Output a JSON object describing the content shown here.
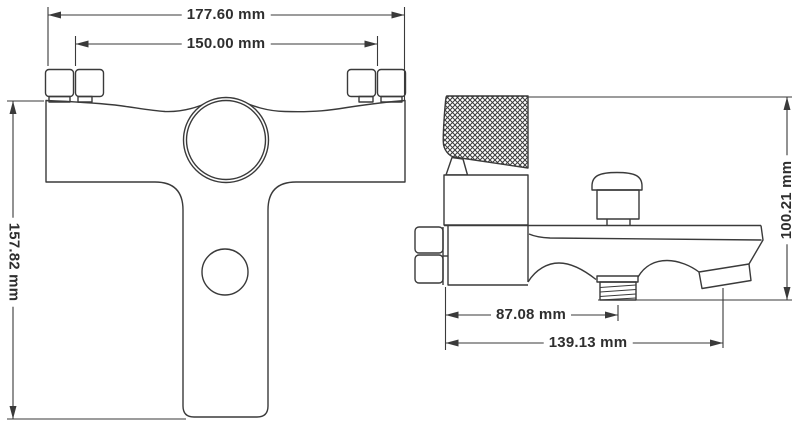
{
  "drawing": {
    "front_view": {
      "overall_width": "177.60 mm",
      "mounting_centers": "150.00 mm",
      "overall_height": "157.82 mm"
    },
    "side_view": {
      "overall_height": "100.21 mm",
      "shower_outlet_offset": "87.08 mm",
      "overall_depth": "139.13 mm"
    },
    "line_color": "#3a3a3a",
    "background_color": "#ffffff"
  }
}
